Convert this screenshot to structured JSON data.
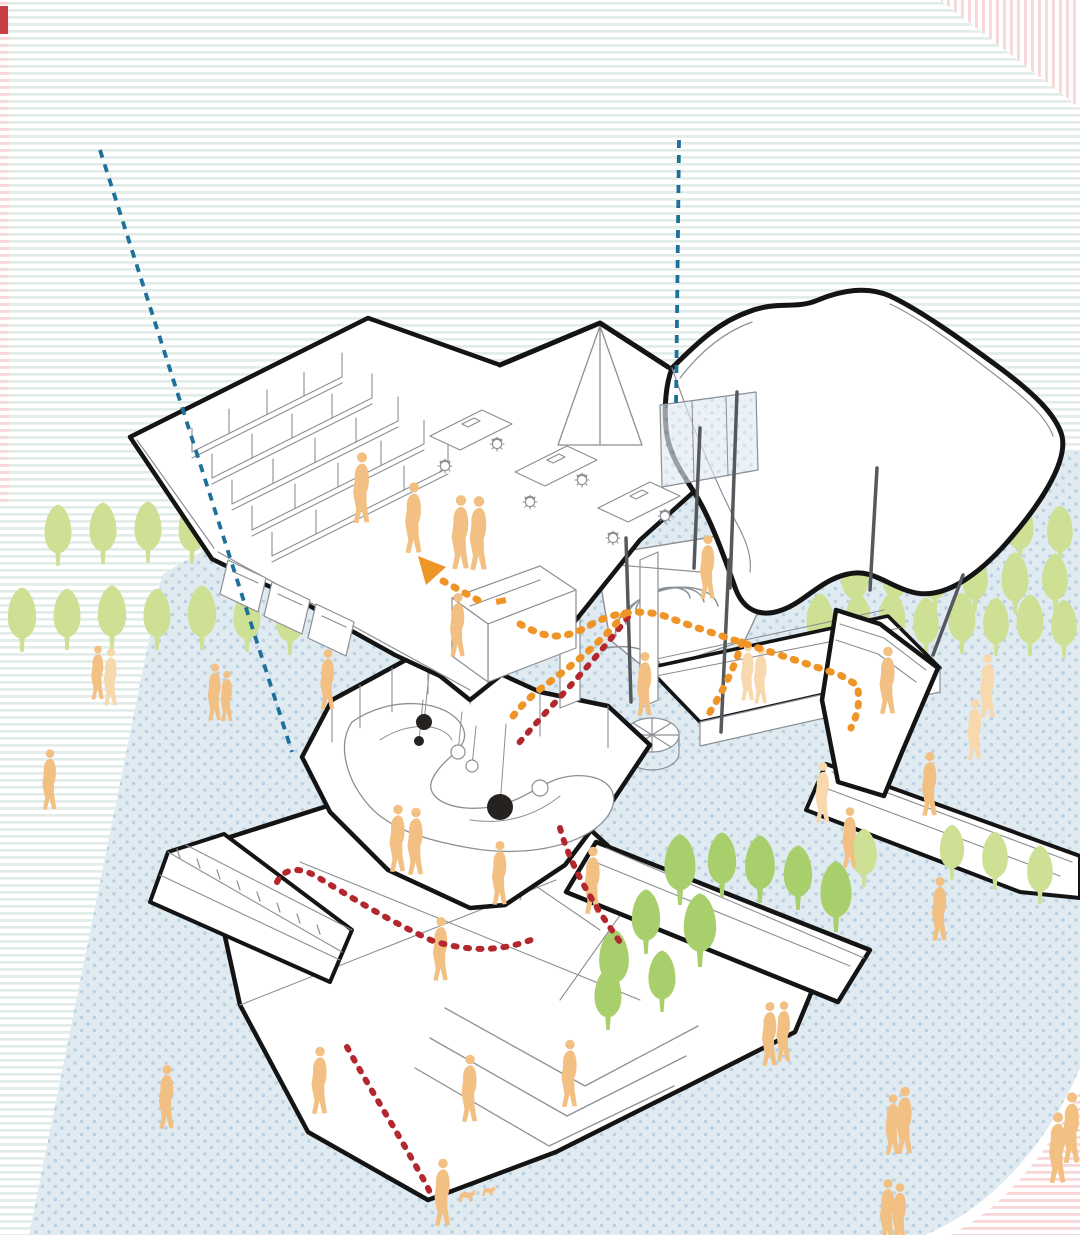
{
  "meta": {
    "type": "architectural-exploded-axonometric-diagram",
    "canvas_width": 1080,
    "canvas_height": 1235
  },
  "palette": {
    "ink": "#141414",
    "thin_line": "#8b9095",
    "stripe_teal": "#e2edea",
    "stripe_pink": "#f7d7d7",
    "corner_square_red": "#c84046",
    "dot_bg": "#e0eaf1",
    "dot": "#bad1e1",
    "tree_light": "#cde094",
    "tree_medium": "#a8cf6b",
    "person_orange": "#f3c083",
    "person_light": "#f8d9ae",
    "route_orange": "#ef9426",
    "route_red": "#b3282e",
    "guide_blue": "#1d7099",
    "post_gray": "#55595e"
  },
  "icons": {
    "tree": "tree-glyph",
    "person": "person-glyph",
    "dog": "dog-glyph",
    "chair": "chair-glyph"
  },
  "building_layers": [
    {
      "name": "roof-plate"
    },
    {
      "name": "upper-floor-offices"
    },
    {
      "name": "wavy-canopy"
    },
    {
      "name": "mezzanine-play-floor"
    },
    {
      "name": "garden-wing"
    },
    {
      "name": "ground-plate-ramp"
    }
  ],
  "annotations": {
    "guide_lines": [
      {
        "x1": 100,
        "y1": 150,
        "x2": 292,
        "y2": 752
      },
      {
        "x1": 679,
        "y1": 140,
        "x2": 676,
        "y2": 406
      }
    ],
    "routes_orange": [
      "M443,581 L485,604",
      "M520,624 C548,640 565,640 592,624 C618,610 648,609 670,618 C695,628 760,648 840,675 L857,685 C861,702 857,716 851,728",
      "M625,613 C604,639 578,661 551,681 C534,693 521,705 511,719",
      "M742,642 C734,670 721,694 707,717"
    ],
    "routes_red": [
      "M628,617 C605,647 577,679 549,709 C536,723 526,735 517,745",
      "M277,882 C283,869 299,865 319,878 C354,899 393,923 433,941 C467,951 499,953 536,938",
      "M347,1047 C369,1087 393,1125 413,1161 C421,1175 427,1185 431,1195",
      "M560,828 C569,861 587,893 607,923 L624,948"
    ],
    "arrow_points": "418,556 446,567 426,585"
  },
  "posts": [
    [
      626,
      538,
      631,
      702
    ],
    [
      737,
      392,
      730,
      588
    ],
    [
      700,
      428,
      694,
      568
    ],
    [
      729,
      560,
      721,
      732
    ],
    [
      877,
      468,
      870,
      590
    ],
    [
      963,
      575,
      933,
      655
    ]
  ],
  "trees_back": [
    [
      58,
      566,
      1.0,
      "l"
    ],
    [
      103,
      564,
      1.0,
      "l"
    ],
    [
      148,
      563,
      1.0,
      "l"
    ],
    [
      192,
      564,
      1.0,
      "l"
    ],
    [
      22,
      652,
      1.05,
      "l"
    ],
    [
      67,
      650,
      1.0,
      "l"
    ],
    [
      112,
      650,
      1.05,
      "l"
    ],
    [
      157,
      650,
      1.0,
      "l"
    ],
    [
      202,
      650,
      1.05,
      "l"
    ],
    [
      247,
      652,
      1.0,
      "l"
    ],
    [
      290,
      655,
      1.05,
      "l"
    ],
    [
      900,
      562,
      0.95,
      "l"
    ],
    [
      940,
      560,
      1.0,
      "l"
    ],
    [
      980,
      562,
      0.95,
      "l"
    ],
    [
      1020,
      562,
      1.0,
      "l"
    ],
    [
      1060,
      564,
      0.95,
      "l"
    ],
    [
      855,
      612,
      1.0,
      "l"
    ],
    [
      895,
      610,
      0.95,
      "l"
    ],
    [
      935,
      612,
      1.0,
      "l"
    ],
    [
      975,
      612,
      0.95,
      "l"
    ],
    [
      1015,
      614,
      1.0,
      "l"
    ],
    [
      1055,
      612,
      0.95,
      "l"
    ],
    [
      820,
      655,
      1.0,
      "l"
    ],
    [
      858,
      652,
      0.95,
      "l"
    ],
    [
      892,
      654,
      1.0,
      "l"
    ],
    [
      926,
      656,
      0.95,
      "l"
    ],
    [
      962,
      654,
      1.0,
      "l"
    ],
    [
      996,
      656,
      0.95,
      "l"
    ],
    [
      1030,
      656,
      1.0,
      "l"
    ],
    [
      1064,
      658,
      0.95,
      "l"
    ]
  ],
  "trees_front": [
    [
      680,
      905,
      1.15,
      "m"
    ],
    [
      722,
      897,
      1.05,
      "m"
    ],
    [
      760,
      903,
      1.1,
      "m"
    ],
    [
      798,
      910,
      1.05,
      "m"
    ],
    [
      836,
      932,
      1.15,
      "m"
    ],
    [
      700,
      967,
      1.2,
      "m"
    ],
    [
      646,
      954,
      1.05,
      "m"
    ],
    [
      614,
      997,
      1.1,
      "m"
    ],
    [
      662,
      1012,
      1.0,
      "m"
    ],
    [
      608,
      1030,
      1.0,
      "m"
    ],
    [
      864,
      887,
      0.95,
      "l"
    ],
    [
      952,
      880,
      0.9,
      "l"
    ],
    [
      995,
      890,
      0.95,
      "l"
    ],
    [
      1040,
      904,
      0.95,
      "l"
    ]
  ],
  "people": [
    [
      362,
      500,
      1.05,
      "o"
    ],
    [
      414,
      530,
      1.05,
      "o"
    ],
    [
      461,
      545,
      1.1,
      "o"
    ],
    [
      479,
      546,
      1.1,
      "o"
    ],
    [
      458,
      636,
      0.95,
      "o"
    ],
    [
      708,
      578,
      0.95,
      "o"
    ],
    [
      645,
      695,
      0.95,
      "o"
    ],
    [
      98,
      682,
      0.8,
      "o"
    ],
    [
      111,
      687,
      0.85,
      "l"
    ],
    [
      215,
      702,
      0.85,
      "o"
    ],
    [
      227,
      705,
      0.75,
      "o"
    ],
    [
      50,
      790,
      0.9,
      "o"
    ],
    [
      748,
      682,
      0.85,
      "l"
    ],
    [
      761,
      685,
      0.85,
      "l"
    ],
    [
      888,
      692,
      1.0,
      "o"
    ],
    [
      988,
      697,
      0.95,
      "l"
    ],
    [
      823,
      803,
      0.9,
      "l"
    ],
    [
      328,
      690,
      0.9,
      "o"
    ],
    [
      398,
      850,
      1.0,
      "o"
    ],
    [
      416,
      853,
      1.0,
      "o"
    ],
    [
      500,
      884,
      0.95,
      "o"
    ],
    [
      593,
      892,
      1.0,
      "o"
    ],
    [
      441,
      960,
      0.95,
      "o"
    ],
    [
      850,
      848,
      0.9,
      "o"
    ],
    [
      930,
      795,
      0.95,
      "o"
    ],
    [
      975,
      740,
      0.9,
      "l"
    ],
    [
      940,
      920,
      0.95,
      "o"
    ],
    [
      167,
      1108,
      0.95,
      "o"
    ],
    [
      320,
      1092,
      1.0,
      "o"
    ],
    [
      470,
      1100,
      1.0,
      "o"
    ],
    [
      570,
      1085,
      1.0,
      "o"
    ],
    [
      770,
      1045,
      0.95,
      "o"
    ],
    [
      784,
      1042,
      0.9,
      "o"
    ],
    [
      443,
      1204,
      1.0,
      "o"
    ],
    [
      905,
      1132,
      1.0,
      "o"
    ],
    [
      893,
      1135,
      0.9,
      "o"
    ],
    [
      1058,
      1160,
      1.05,
      "o"
    ],
    [
      1072,
      1140,
      1.05,
      "o"
    ],
    [
      888,
      1222,
      0.95,
      "o"
    ],
    [
      900,
      1224,
      0.9,
      "o"
    ]
  ],
  "dogs": [
    [
      466,
      1202,
      1.0
    ],
    [
      488,
      1196,
      0.8
    ]
  ]
}
